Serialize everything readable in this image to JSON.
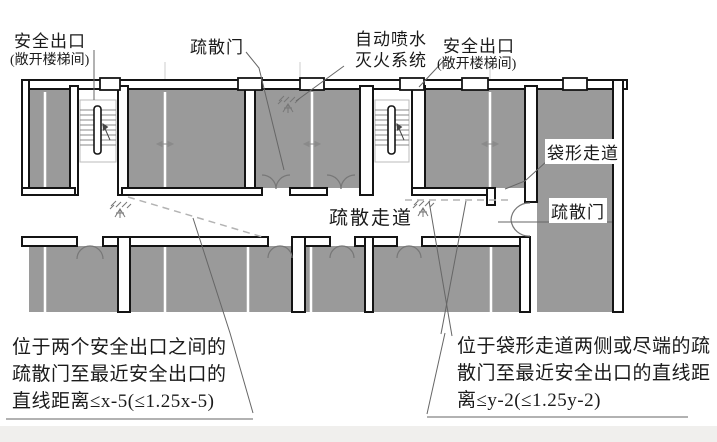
{
  "figure": {
    "labels": {
      "safety_exit_left": "安全出口",
      "open_stairwell_left": "(敞开楼梯间)",
      "evac_door_top": "疏散门",
      "sprinkler_line1": "自动喷水",
      "sprinkler_line2": "灭火系统",
      "safety_exit_right": "安全出口",
      "open_stairwell_right": "(敞开楼梯间)",
      "dead_end_corridor": "袋形走道",
      "evac_door_right": "疏散门",
      "evac_corridor": "疏散走道"
    },
    "callouts": {
      "left": {
        "line1": "位于两个安全出口之间的",
        "line2": "疏散门至最近安全出口的",
        "line3": "直线距离≤x-5(≤1.25x-5)"
      },
      "right": {
        "line1": "位于袋形走道两侧或尽端的疏",
        "line2": "散门至最近安全出口的直线距",
        "line3": "离≤y-2(≤1.25y-2)"
      }
    },
    "colors": {
      "room_fill": "#9a9a9a",
      "wall_stroke": "#141414",
      "dashed_line": "#b3b3b3",
      "leader_line": "#666666",
      "text": "#1a1a1a",
      "background": "#ffffff"
    }
  }
}
